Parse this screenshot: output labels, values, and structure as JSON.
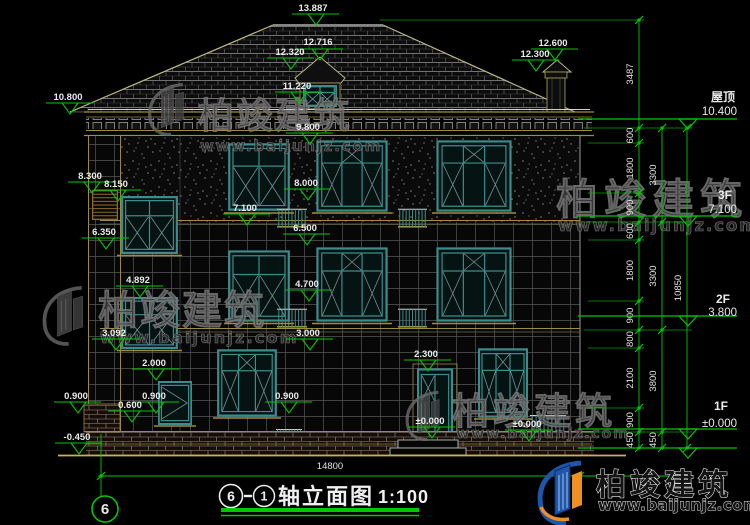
{
  "title": {
    "axis_start": "6",
    "axis_end": "1",
    "text": "轴立面图",
    "scale": "1:100"
  },
  "axis_bubble": "6",
  "bottom_dimension": "14800",
  "levels": {
    "roof": {
      "label": "屋顶",
      "value": "10.400"
    },
    "f3": {
      "label": "3F",
      "value": "7.100"
    },
    "f2": {
      "label": "2F",
      "value": "3.800"
    },
    "f1": {
      "label": "1F",
      "value": "±0.000"
    }
  },
  "elevation_markers": {
    "ridge": "13.887",
    "dormer_top": "12.716",
    "dormer_eave": "12.320",
    "dormer_sill": "11.220",
    "chimney_top": "12.600",
    "chimney_base": "12.300",
    "eave_left": "10.800",
    "w3_top": "9.800",
    "stair_upper": "8.300",
    "stair_upper2": "8.150",
    "w3_sill": "8.000",
    "f3_floor": "7.100",
    "w2_top": "6.500",
    "stair_mid": "6.350",
    "stair_low": "4.892",
    "w2_sill": "4.700",
    "stair_low2": "3.092",
    "w1_top": "3.000",
    "door_top": "2.300",
    "win_small_top": "2.000",
    "porch_left": "0.900",
    "win_small_sill": "0.900",
    "plinth": "0.600",
    "w1_sill": "0.900",
    "door_base": "±0.000",
    "ground_right": "±0.000",
    "ground": "-0.450"
  },
  "dims": {
    "right_inner": [
      "3487",
      "600",
      "1800",
      "900",
      "600",
      "1800",
      "900",
      "800",
      "2100",
      "900",
      "450"
    ],
    "right_middle": [
      "3300",
      "3300",
      "3800",
      "450"
    ],
    "right_outer": [
      "10850"
    ]
  },
  "watermark": {
    "brand": "柏竣建筑",
    "site": "www.baijunjz.com"
  },
  "logo": {
    "brand": "柏竣建筑",
    "site": "www.baijunjz.com"
  },
  "colors": {
    "background": "#000000",
    "cad_green": "#00c800",
    "cad_yellow": "#a08c3c",
    "window_teal": "#3c8c8c",
    "logo_blue": "#1e56aa",
    "logo_orange": "#ef9020"
  }
}
